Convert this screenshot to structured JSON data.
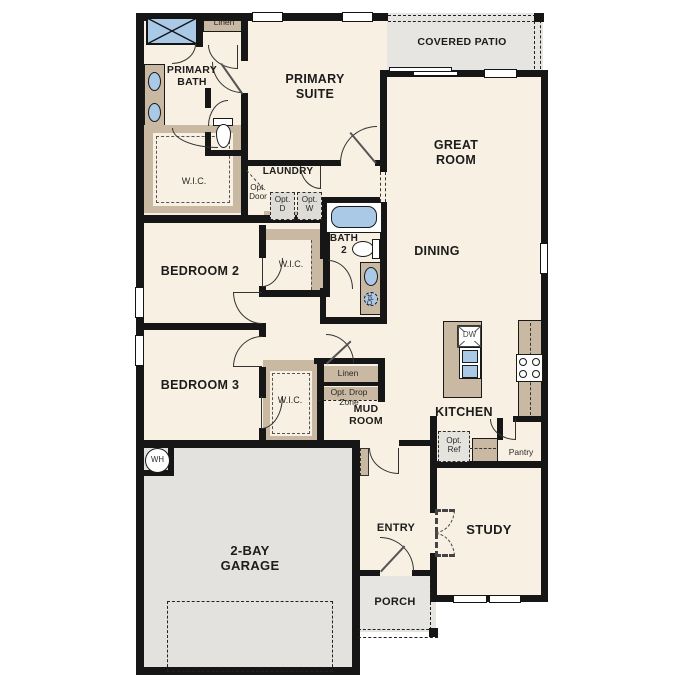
{
  "title": "Single-story floor plan",
  "rooms": {
    "covered_patio": "COVERED PATIO",
    "primary_suite": "PRIMARY SUITE",
    "primary_bath": "PRIMARY BATH",
    "great_room": "GREAT ROOM",
    "dining": "DINING",
    "laundry": "LAUNDRY",
    "bath2": "BATH 2",
    "bedroom2": "BEDROOM 2",
    "bedroom3": "BEDROOM 3",
    "mud_room": "MUD ROOM",
    "kitchen": "KITCHEN",
    "study": "STUDY",
    "entry": "ENTRY",
    "porch": "PORCH",
    "garage": "2-BAY GARAGE",
    "pantry": "Pantry"
  },
  "labels": {
    "wic": "W.I.C.",
    "linen": "Linen"
  },
  "options": {
    "opt_door": "Opt. Door",
    "opt_dryer": "Opt. D",
    "opt_washer": "Opt. W",
    "opt_ref": "Opt. Ref",
    "opt_drop_zone": "Opt. Drop Zone",
    "opt_fixture": "Opt."
  },
  "appliances": {
    "water_heater": "WH",
    "dishwasher": "DW"
  },
  "colors": {
    "floor": "#f8f0e2",
    "wall": "#161616",
    "cabinet": "#c9b8a2",
    "fixture_blue": "#aac9e6",
    "outdoor": "#e6e5e1"
  }
}
